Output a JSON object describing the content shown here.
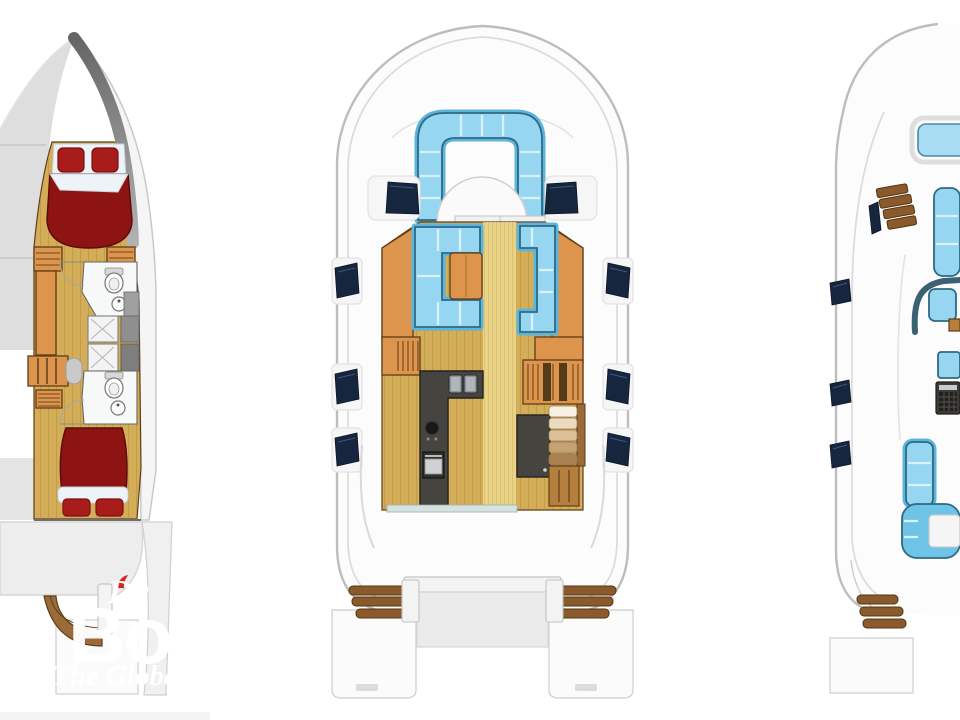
{
  "watermark": {
    "script_text": "Da",
    "brand_text": "Bo",
    "tagline_text": "The Globa"
  },
  "palette": {
    "hull_line": "#bdbdbd",
    "deck_white": "#fcfcfc",
    "inner_line": "#dcdcdc",
    "wood_floor": "#d4ad58",
    "wood_line": "#a9822f",
    "walkway_wood": "#ecd98e",
    "cabinet_orange": "#dd944c",
    "cabinet_edge": "#5f3c16",
    "walnut": "#b5803d",
    "bed_maroon": "#8e1414",
    "pillow_red": "#a81c1c",
    "sheet_white": "#eef3f7",
    "seat_blue": "#97d6f1",
    "seat_blue_deep": "#5cb6dc",
    "seat_edge": "#2f6a84",
    "seat_gap": "#d9f1fb",
    "hatch_navy": "#16263f",
    "counter_dark": "#45443e",
    "transom_wood": "#8a5a2c",
    "transom_wood_edge": "#54350f",
    "platform_gray": "#ededed",
    "wm_accent": "#d8232a",
    "wm_text": "#ffffff"
  }
}
